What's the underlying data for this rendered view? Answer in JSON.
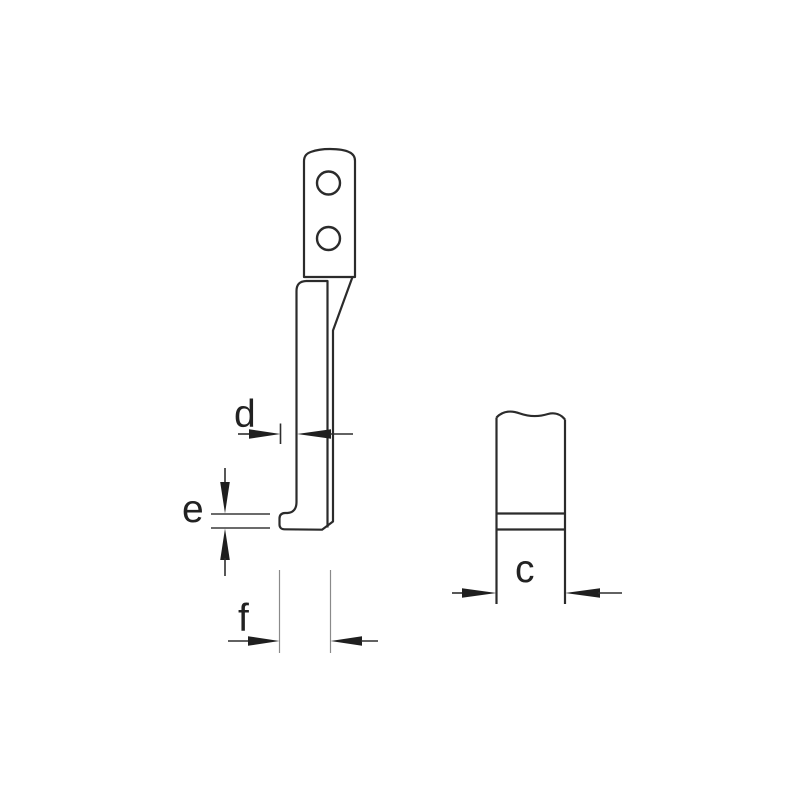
{
  "drawing": {
    "type": "technical-dimension-diagram",
    "background_color": "#ffffff",
    "stroke_color": "#2b2b2b",
    "views": {
      "side_view": "puller-leg-side-view-with-two-mounting-holes-and-hook-foot",
      "front_view": "hook-foot-front-view-with-break-line"
    },
    "dimension_labels": {
      "d": "d",
      "e": "e",
      "f": "f",
      "c": "c"
    }
  }
}
